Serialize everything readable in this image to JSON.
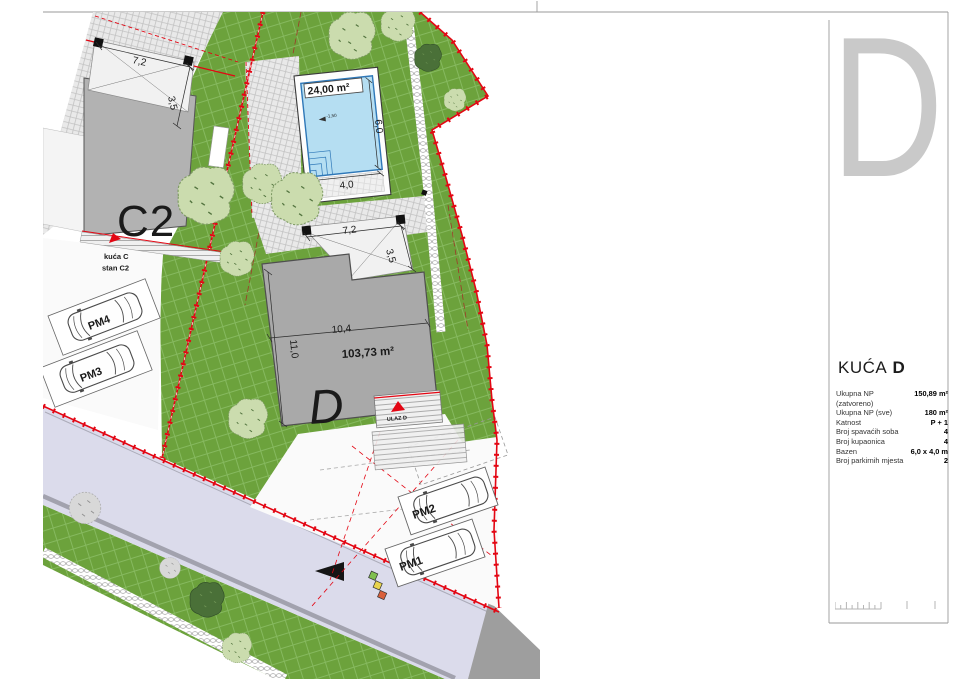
{
  "plan": {
    "houses": {
      "c2": {
        "label": "C2",
        "note1": "kuća C",
        "note2": "stan C2"
      },
      "d": {
        "label": "D",
        "area": "103,73 m²",
        "dim_width": "10,4",
        "dim_height": "11,0",
        "entrance": "ULAZ D"
      }
    },
    "terraces": {
      "c": {
        "dim_w": "7,2",
        "dim_d": "3,5"
      },
      "d": {
        "dim_w": "7,2",
        "dim_d": "3,5"
      }
    },
    "pool": {
      "area": "24,00 m²",
      "dim_l": "6,0",
      "dim_w": "4,0",
      "level": "-1,50"
    },
    "parking": {
      "pm1": "PM1",
      "pm2": "PM2",
      "pm3": "PM3",
      "pm4": "PM4"
    }
  },
  "sidebar": {
    "watermark": "D",
    "title_prefix": "KUĆA",
    "title_letter": "D",
    "rows": [
      {
        "label": "Ukupna NP (zatvoreno)",
        "value": "150,89 m²"
      },
      {
        "label": "Ukupna NP (sve)",
        "value": "180 m²"
      },
      {
        "label": "Katnost",
        "value": "P + 1"
      },
      {
        "label": "Broj spavaćih soba",
        "value": "4"
      },
      {
        "label": "Broj kupaonica",
        "value": "4"
      },
      {
        "label": "Bazen",
        "value": "6,0 x 4,0 m"
      },
      {
        "label": "Broj parkirnih mjesta",
        "value": "2"
      }
    ]
  },
  "colors": {
    "parcel_red": "#E30613",
    "grass_green": "#6CA23C",
    "road_lavender": "#DBDBEB",
    "pool_blue": "#B5DEF2",
    "building_gray": "#A9A9A9",
    "watermark_gray": "#C9C9C9"
  }
}
